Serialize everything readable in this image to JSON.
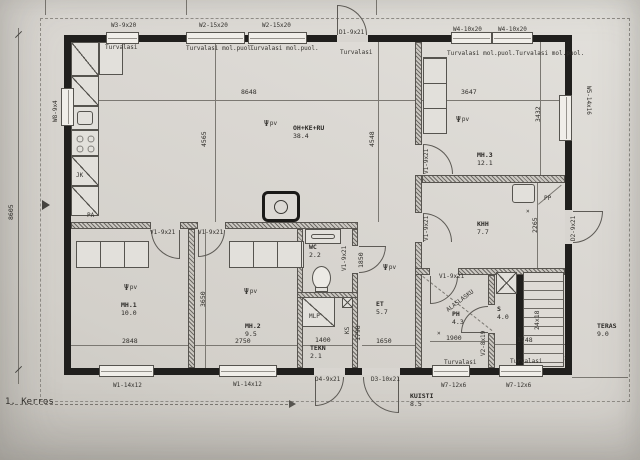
{
  "drawing": {
    "floor_label": "1. Kerros",
    "colors": {
      "paper": "#d8d5d0",
      "wall": "#201f1d",
      "line": "#56544f",
      "text": "#33312d"
    },
    "rooms": [
      {
        "name": "OH+KE+RU",
        "area": "38.4",
        "x": 293,
        "y": 124
      },
      {
        "name": "MH.3",
        "area": "12.1",
        "x": 477,
        "y": 151
      },
      {
        "name": "KHH",
        "area": "7.7",
        "x": 477,
        "y": 220
      },
      {
        "name": "MH.1",
        "area": "10.0",
        "x": 121,
        "y": 301
      },
      {
        "name": "MH.2",
        "area": "9.5",
        "x": 245,
        "y": 322
      },
      {
        "name": "WC",
        "area": "2.2",
        "x": 309,
        "y": 243
      },
      {
        "name": "TEKN",
        "area": "2.1",
        "x": 310,
        "y": 344
      },
      {
        "name": "ET",
        "area": "5.7",
        "x": 376,
        "y": 300
      },
      {
        "name": "PH",
        "area": "4.3",
        "x": 452,
        "y": 310
      },
      {
        "name": "S",
        "area": "4.0",
        "x": 497,
        "y": 305
      },
      {
        "name": "KUISTI",
        "area": "8.5",
        "x": 410,
        "y": 392
      },
      {
        "name": "TERAS",
        "area": "9.0",
        "x": 597,
        "y": 322
      }
    ],
    "opening_labels": [
      {
        "text": "W3-9x20",
        "x": 111,
        "y": 22
      },
      {
        "text": "W2-15x20",
        "x": 199,
        "y": 22
      },
      {
        "text": "W2-15x20",
        "x": 262,
        "y": 22
      },
      {
        "text": "D1-9x21",
        "x": 339,
        "y": 29
      },
      {
        "text": "W4-10x20",
        "x": 453,
        "y": 26
      },
      {
        "text": "W4-10x20",
        "x": 498,
        "y": 26
      },
      {
        "text": "W8-9x4",
        "x": 52,
        "y": 122,
        "rot": -90
      },
      {
        "text": "W5-14x16",
        "x": 592,
        "y": 86,
        "rot": 90
      },
      {
        "text": "W1-14x12",
        "x": 113,
        "y": 382
      },
      {
        "text": "W1-14x12",
        "x": 233,
        "y": 381
      },
      {
        "text": "D4-9x21",
        "x": 315,
        "y": 376
      },
      {
        "text": "D3-10x21",
        "x": 371,
        "y": 376
      },
      {
        "text": "W7-12x6",
        "x": 441,
        "y": 382
      },
      {
        "text": "W7-12x6",
        "x": 506,
        "y": 382
      },
      {
        "text": "D2-9x21",
        "x": 570,
        "y": 241,
        "rot": -90
      },
      {
        "text": "V1-9x21",
        "x": 150,
        "y": 229
      },
      {
        "text": "V1-9x21",
        "x": 198,
        "y": 229
      },
      {
        "text": "V1-9x21",
        "x": 341,
        "y": 271,
        "rot": -90
      },
      {
        "text": "V1-9x21",
        "x": 423,
        "y": 174,
        "rot": -90
      },
      {
        "text": "V1-9x21",
        "x": 423,
        "y": 241,
        "rot": -90
      },
      {
        "text": "V1-9x21",
        "x": 439,
        "y": 273
      },
      {
        "text": "V2-8x19",
        "x": 480,
        "y": 356,
        "rot": -90
      }
    ],
    "glass_labels": [
      {
        "text": "Turvalasi",
        "x": 105,
        "y": 44
      },
      {
        "text": "Turvalasi mol.puol.",
        "x": 186,
        "y": 45
      },
      {
        "text": "Turvalasi mol.puol.",
        "x": 250,
        "y": 45
      },
      {
        "text": "Turvalasi",
        "x": 340,
        "y": 49
      },
      {
        "text": "Turvalasi mol.puol.Turvalasi mol.puol.",
        "x": 447,
        "y": 50
      },
      {
        "text": "Turvalasi",
        "x": 444,
        "y": 359
      },
      {
        "text": "Turvalasi",
        "x": 510,
        "y": 358
      }
    ],
    "dim_labels": [
      {
        "text": "8648",
        "x": 241,
        "y": 89
      },
      {
        "text": "3647",
        "x": 461,
        "y": 89
      },
      {
        "text": "8605",
        "x": 8,
        "y": 220,
        "rot": -90
      },
      {
        "text": "4565",
        "x": 201,
        "y": 147,
        "rot": -90
      },
      {
        "text": "4548",
        "x": 369,
        "y": 147,
        "rot": -90
      },
      {
        "text": "3432",
        "x": 535,
        "y": 122,
        "rot": -90
      },
      {
        "text": "3650",
        "x": 200,
        "y": 307,
        "rot": -90
      },
      {
        "text": "2848",
        "x": 122,
        "y": 338
      },
      {
        "text": "2750",
        "x": 235,
        "y": 338
      },
      {
        "text": "1850",
        "x": 358,
        "y": 268,
        "rot": -90
      },
      {
        "text": "1798",
        "x": 355,
        "y": 341,
        "rot": -90
      },
      {
        "text": "1650",
        "x": 376,
        "y": 338
      },
      {
        "text": "1400",
        "x": 315,
        "y": 337
      },
      {
        "text": "1900",
        "x": 446,
        "y": 335
      },
      {
        "text": "2265",
        "x": 532,
        "y": 233,
        "rot": -90
      },
      {
        "text": "1748",
        "x": 517,
        "y": 337
      },
      {
        "text": "24x18",
        "x": 534,
        "y": 330,
        "rot": -90
      }
    ],
    "fixture_labels": [
      {
        "name": "fridge-label",
        "text": "JK",
        "x": 76,
        "y": 172
      },
      {
        "name": "freezer-label",
        "text": "PA",
        "x": 87,
        "y": 212
      },
      {
        "name": "washer-label",
        "text": "PP",
        "x": 544,
        "y": 195
      },
      {
        "name": "boiler-label",
        "text": "MLP",
        "x": 309,
        "y": 313
      },
      {
        "name": "drying-cabinet-label",
        "text": "KS",
        "x": 344,
        "y": 334,
        "rot": -90
      },
      {
        "name": "dropped-ceiling-note",
        "text": "ALASLASKU",
        "x": 445,
        "y": 308,
        "rot": -37
      },
      {
        "name": "ceiling-valve-symbol",
        "text": "×",
        "x": 526,
        "y": 208
      },
      {
        "name": "ceiling-valve-symbol",
        "text": "×",
        "x": 437,
        "y": 330
      }
    ],
    "smoke_detectors": {
      "symbol": "Ψ",
      "label": "pv",
      "points": [
        {
          "x": 264,
          "y": 120
        },
        {
          "x": 456,
          "y": 116
        },
        {
          "x": 124,
          "y": 284
        },
        {
          "x": 244,
          "y": 288
        },
        {
          "x": 383,
          "y": 264
        }
      ]
    }
  }
}
